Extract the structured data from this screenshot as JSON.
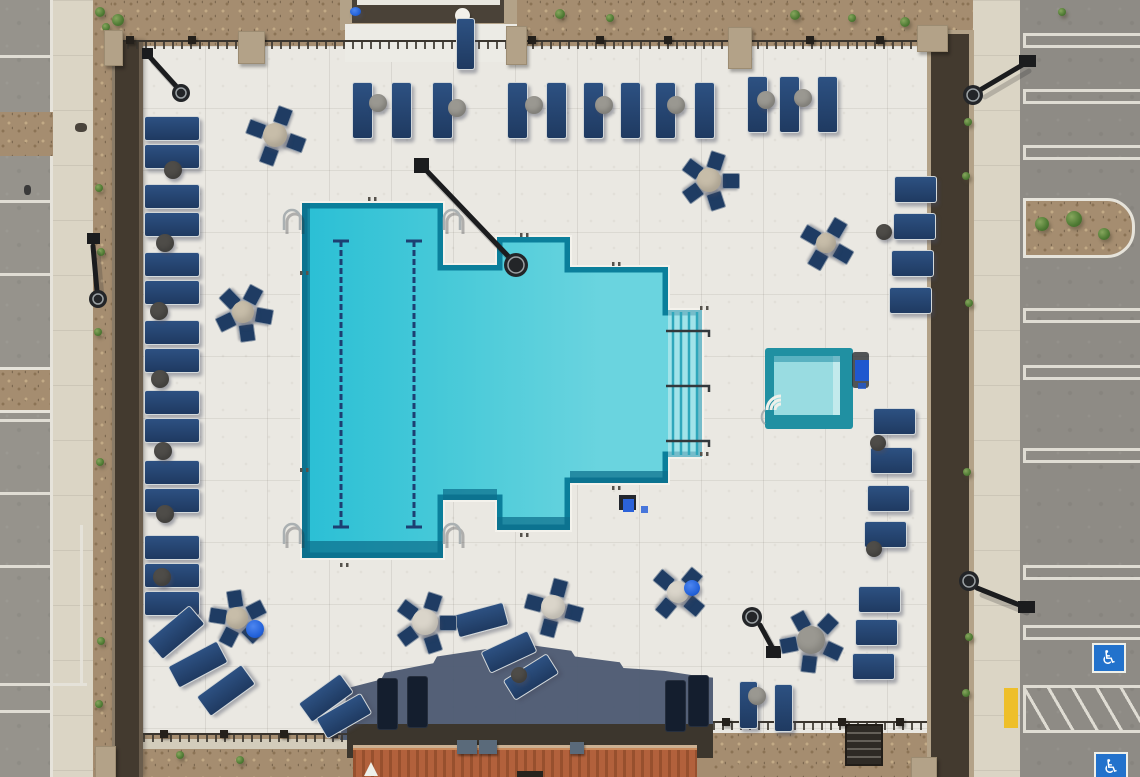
{
  "scene": {
    "kind": "aerial-photo",
    "subject": "apartment community swimming pool deck with spa, loungers and parking lots"
  },
  "icons": {
    "accessible_parking": "♿"
  },
  "colors": {
    "water_main": "#2abfd5",
    "water_mid": "#4ccbd9",
    "water_light": "#6ad4df",
    "water_edge": "#0b7f9b",
    "water_deep": "#0c6f8c",
    "spa_rim": "#2090a2",
    "spa_water": "#99dce1",
    "spa_bench": "#c2eaec",
    "deck": "#eae8e2",
    "asphalt": "#96938c",
    "asphalt2": "#8e8b85",
    "stall": "#e6e3da",
    "sidewalk": "#dbd5c5",
    "gravel": "#a58d70",
    "gravel_dot1": "#8b7355",
    "gravel_dot2": "#c2aa86",
    "wall_dark": "#433a2f",
    "wall_tan": "#b3a288",
    "fence": "#3a352e",
    "shadow": "#4d5b72",
    "roof": "#b2613c",
    "roof_dark": "#97502e",
    "patio": "#3c362d",
    "lounger": "#24456f",
    "lounger_shadow": "#16202f",
    "chair": "#1f3c63",
    "disc_beige": "#c7bda9",
    "disc_cream": "#dad5ca",
    "disc_gray": "#9a9891",
    "table_dark": "#4e4c48",
    "umbrella_blue": "#2160d8",
    "handicap_blue": "#2272cc",
    "curb_yellow": "#eebf2a",
    "lamp": "#1b1c1e",
    "metal": "#aab0b2",
    "white": "#f4f2ec"
  },
  "pool": {
    "outline": [
      [
        302,
        203
      ],
      [
        443,
        203
      ],
      [
        443,
        265
      ],
      [
        497,
        265
      ],
      [
        497,
        237
      ],
      [
        570,
        237
      ],
      [
        570,
        267
      ],
      [
        668,
        267
      ],
      [
        668,
        310
      ],
      [
        702,
        310
      ],
      [
        702,
        457
      ],
      [
        668,
        457
      ],
      [
        668,
        483
      ],
      [
        570,
        483
      ],
      [
        570,
        530
      ],
      [
        497,
        530
      ],
      [
        497,
        500
      ],
      [
        443,
        500
      ],
      [
        443,
        558
      ],
      [
        302,
        558
      ]
    ],
    "lane_lines": {
      "x": [
        341,
        414
      ],
      "y1": 241,
      "y2": 527
    },
    "bottom_bands": [
      [
        302,
        541,
        141,
        17
      ],
      [
        443,
        489,
        54,
        11
      ],
      [
        497,
        517,
        73,
        13
      ],
      [
        570,
        471,
        98,
        12
      ],
      [
        302,
        203,
        8,
        355
      ]
    ],
    "stairs": {
      "x1": 668,
      "x2": 702,
      "steps_x": [
        673,
        681,
        689,
        697
      ],
      "y1": 312,
      "y2": 455,
      "rails_y": [
        331,
        386,
        441
      ]
    },
    "grab_rails": [
      [
        288,
        214
      ],
      [
        448,
        214
      ],
      [
        288,
        528
      ],
      [
        448,
        528
      ]
    ],
    "depth_marks": [
      [
        368,
        197
      ],
      [
        520,
        233
      ],
      [
        612,
        262
      ],
      [
        340,
        563
      ],
      [
        520,
        533
      ],
      [
        612,
        486
      ],
      [
        300,
        271
      ],
      [
        300,
        468
      ],
      [
        700,
        306
      ],
      [
        700,
        452
      ]
    ],
    "lift": {
      "x": 619,
      "y": 495
    }
  },
  "spa": {
    "x": 765,
    "y": 348,
    "w": 88,
    "h": 81,
    "water": [
      774,
      356,
      66,
      59
    ],
    "bench": [
      833,
      356,
      7,
      59
    ],
    "steps_center": [
      781,
      410
    ],
    "cart": {
      "x": 852,
      "y": 352
    }
  },
  "furniture": {
    "loungers": [
      {
        "x": 144,
        "y": 116,
        "w": 54,
        "h": 23,
        "r": 0
      },
      {
        "x": 144,
        "y": 144,
        "w": 54,
        "h": 23,
        "r": 0
      },
      {
        "x": 144,
        "y": 184,
        "w": 54,
        "h": 23,
        "r": 0
      },
      {
        "x": 144,
        "y": 212,
        "w": 54,
        "h": 23,
        "r": 0
      },
      {
        "x": 144,
        "y": 252,
        "w": 54,
        "h": 23,
        "r": 0
      },
      {
        "x": 144,
        "y": 280,
        "w": 54,
        "h": 23,
        "r": 0
      },
      {
        "x": 144,
        "y": 320,
        "w": 54,
        "h": 23,
        "r": 0
      },
      {
        "x": 144,
        "y": 348,
        "w": 54,
        "h": 23,
        "r": 0
      },
      {
        "x": 144,
        "y": 390,
        "w": 54,
        "h": 23,
        "r": 0
      },
      {
        "x": 144,
        "y": 418,
        "w": 54,
        "h": 23,
        "r": 0
      },
      {
        "x": 144,
        "y": 460,
        "w": 54,
        "h": 23,
        "r": 0
      },
      {
        "x": 144,
        "y": 488,
        "w": 54,
        "h": 23,
        "r": 0
      },
      {
        "x": 144,
        "y": 535,
        "w": 54,
        "h": 23,
        "r": 0
      },
      {
        "x": 144,
        "y": 563,
        "w": 54,
        "h": 23,
        "r": 0
      },
      {
        "x": 144,
        "y": 591,
        "w": 54,
        "h": 23,
        "r": 0
      },
      {
        "x": 148,
        "y": 620,
        "w": 54,
        "h": 23,
        "r": -40
      },
      {
        "x": 170,
        "y": 652,
        "w": 54,
        "h": 23,
        "r": -28
      },
      {
        "x": 198,
        "y": 678,
        "w": 54,
        "h": 23,
        "r": -36
      },
      {
        "x": 352,
        "y": 82,
        "w": 19,
        "h": 55,
        "r": 0
      },
      {
        "x": 391,
        "y": 82,
        "w": 19,
        "h": 55,
        "r": 0
      },
      {
        "x": 432,
        "y": 82,
        "w": 19,
        "h": 55,
        "r": 0
      },
      {
        "x": 507,
        "y": 82,
        "w": 19,
        "h": 55,
        "r": 0
      },
      {
        "x": 546,
        "y": 82,
        "w": 19,
        "h": 55,
        "r": 0
      },
      {
        "x": 583,
        "y": 82,
        "w": 19,
        "h": 55,
        "r": 0
      },
      {
        "x": 620,
        "y": 82,
        "w": 19,
        "h": 55,
        "r": 0
      },
      {
        "x": 655,
        "y": 82,
        "w": 19,
        "h": 55,
        "r": 0
      },
      {
        "x": 694,
        "y": 82,
        "w": 19,
        "h": 55,
        "r": 0
      },
      {
        "x": 747,
        "y": 76,
        "w": 19,
        "h": 55,
        "r": 0
      },
      {
        "x": 779,
        "y": 76,
        "w": 19,
        "h": 55,
        "r": 0
      },
      {
        "x": 817,
        "y": 76,
        "w": 19,
        "h": 55,
        "r": 0
      },
      {
        "x": 456,
        "y": 18,
        "w": 17,
        "h": 50,
        "r": 0
      },
      {
        "x": 894,
        "y": 176,
        "w": 41,
        "h": 25,
        "r": 0
      },
      {
        "x": 893,
        "y": 213,
        "w": 41,
        "h": 25,
        "r": 0
      },
      {
        "x": 891,
        "y": 250,
        "w": 41,
        "h": 25,
        "r": 0
      },
      {
        "x": 889,
        "y": 287,
        "w": 41,
        "h": 25,
        "r": 0
      },
      {
        "x": 873,
        "y": 408,
        "w": 41,
        "h": 25,
        "r": 0
      },
      {
        "x": 870,
        "y": 447,
        "w": 41,
        "h": 25,
        "r": 0
      },
      {
        "x": 867,
        "y": 485,
        "w": 41,
        "h": 25,
        "r": 0
      },
      {
        "x": 864,
        "y": 521,
        "w": 41,
        "h": 25,
        "r": 0
      },
      {
        "x": 858,
        "y": 586,
        "w": 41,
        "h": 25,
        "r": 0
      },
      {
        "x": 855,
        "y": 619,
        "w": 41,
        "h": 25,
        "r": 0
      },
      {
        "x": 852,
        "y": 653,
        "w": 41,
        "h": 25,
        "r": 0
      },
      {
        "x": 455,
        "y": 608,
        "w": 50,
        "h": 22,
        "r": -15
      },
      {
        "x": 483,
        "y": 640,
        "w": 50,
        "h": 22,
        "r": -25
      },
      {
        "x": 505,
        "y": 665,
        "w": 50,
        "h": 22,
        "r": -32
      },
      {
        "x": 300,
        "y": 686,
        "w": 50,
        "h": 22,
        "r": -36
      },
      {
        "x": 318,
        "y": 704,
        "w": 50,
        "h": 22,
        "r": -30
      },
      {
        "x": 739,
        "y": 681,
        "w": 17,
        "h": 46,
        "r": 0
      },
      {
        "x": 774,
        "y": 684,
        "w": 17,
        "h": 46,
        "r": 0
      }
    ],
    "shadow_loungers": [
      {
        "x": 377,
        "y": 678
      },
      {
        "x": 407,
        "y": 676
      },
      {
        "x": 665,
        "y": 680
      },
      {
        "x": 688,
        "y": 675
      }
    ],
    "side_tables": [
      {
        "x": 173,
        "y": 170,
        "r": 9,
        "c": "table_dark"
      },
      {
        "x": 165,
        "y": 243,
        "r": 9,
        "c": "table_dark"
      },
      {
        "x": 159,
        "y": 311,
        "r": 9,
        "c": "table_dark"
      },
      {
        "x": 160,
        "y": 379,
        "r": 9,
        "c": "table_dark"
      },
      {
        "x": 163,
        "y": 451,
        "r": 9,
        "c": "table_dark"
      },
      {
        "x": 165,
        "y": 514,
        "r": 9,
        "c": "table_dark"
      },
      {
        "x": 162,
        "y": 577,
        "r": 9,
        "c": "table_dark"
      },
      {
        "x": 378,
        "y": 103,
        "r": 9,
        "c": "disc_gray"
      },
      {
        "x": 457,
        "y": 108,
        "r": 9,
        "c": "disc_gray"
      },
      {
        "x": 534,
        "y": 105,
        "r": 9,
        "c": "disc_gray"
      },
      {
        "x": 604,
        "y": 105,
        "r": 9,
        "c": "disc_gray"
      },
      {
        "x": 676,
        "y": 105,
        "r": 9,
        "c": "disc_gray"
      },
      {
        "x": 766,
        "y": 100,
        "r": 9,
        "c": "disc_gray"
      },
      {
        "x": 803,
        "y": 98,
        "r": 9,
        "c": "disc_gray"
      },
      {
        "x": 884,
        "y": 232,
        "r": 8,
        "c": "table_dark"
      },
      {
        "x": 878,
        "y": 443,
        "r": 8,
        "c": "table_dark"
      },
      {
        "x": 874,
        "y": 549,
        "r": 8,
        "c": "table_dark"
      },
      {
        "x": 519,
        "y": 675,
        "r": 8,
        "c": "table_dark"
      },
      {
        "x": 757,
        "y": 696,
        "r": 9,
        "c": "disc_gray"
      }
    ],
    "table_sets": [
      {
        "cx": 275,
        "cy": 135,
        "r": 12,
        "c": "disc_beige",
        "n": 4,
        "a0": 20
      },
      {
        "cx": 709,
        "cy": 180,
        "r": 12,
        "c": "disc_beige",
        "n": 5,
        "a0": 0
      },
      {
        "cx": 826,
        "cy": 243,
        "r": 10,
        "c": "disc_beige",
        "n": 4,
        "a0": 30
      },
      {
        "cx": 243,
        "cy": 312,
        "r": 11,
        "c": "disc_beige",
        "n": 5,
        "a0": 10
      },
      {
        "cx": 237,
        "cy": 618,
        "r": 11,
        "c": "disc_beige",
        "n": 5,
        "a0": 45,
        "blue": [
          255,
          629,
          9
        ]
      },
      {
        "cx": 553,
        "cy": 607,
        "r": 12,
        "c": "disc_cream",
        "n": 4,
        "a0": 15
      },
      {
        "cx": 425,
        "cy": 622,
        "r": 13,
        "c": "disc_cream",
        "n": 5,
        "a0": 0,
        "spokes": true
      },
      {
        "cx": 811,
        "cy": 640,
        "r": 14,
        "c": "disc_gray",
        "n": 5,
        "a0": 25,
        "spokes": true
      },
      {
        "cx": 678,
        "cy": 592,
        "r": 11,
        "c": "disc_cream",
        "n": 4,
        "a0": 40,
        "blue": [
          692,
          588,
          8
        ]
      }
    ]
  },
  "parking": {
    "left_lines_y": [
      55,
      128,
      200,
      273,
      419,
      492,
      565,
      710
    ],
    "left_vertical": [
      80,
      525,
      158
    ],
    "left_horizontal": [
      0,
      683,
      87
    ],
    "right_lines_y": [
      33,
      89,
      145,
      308,
      365,
      448,
      565,
      625
    ],
    "handicap": [
      [
        1092,
        643
      ],
      [
        1094,
        752
      ]
    ],
    "hatch": [
      1023,
      685,
      117,
      42
    ],
    "yellow_curb": [
      1004,
      688,
      14,
      40
    ]
  },
  "islands": {
    "right": {
      "x": 1023,
      "y": 198,
      "w": 106,
      "h": 54,
      "trees": [
        [
          1042,
          224,
          7
        ],
        [
          1074,
          219,
          8
        ],
        [
          1104,
          234,
          6
        ]
      ]
    },
    "left": {
      "x": 0,
      "y": 367,
      "w": 50,
      "h": 40,
      "shrub": [
        27,
        386,
        6
      ]
    }
  },
  "plants": [
    [
      100,
      12,
      5
    ],
    [
      106,
      27,
      4
    ],
    [
      118,
      20,
      6
    ],
    [
      99,
      188,
      4
    ],
    [
      101,
      252,
      4
    ],
    [
      98,
      332,
      4
    ],
    [
      100,
      462,
      4
    ],
    [
      101,
      641,
      4
    ],
    [
      99,
      704,
      4
    ],
    [
      968,
      122,
      4
    ],
    [
      966,
      176,
      4
    ],
    [
      969,
      303,
      4
    ],
    [
      967,
      472,
      4
    ],
    [
      969,
      637,
      4
    ],
    [
      966,
      693,
      4
    ],
    [
      560,
      14,
      5
    ],
    [
      610,
      18,
      4
    ],
    [
      795,
      15,
      5
    ],
    [
      852,
      18,
      4
    ],
    [
      905,
      22,
      5
    ],
    [
      1062,
      12,
      4
    ],
    [
      180,
      755,
      4
    ],
    [
      240,
      760,
      4
    ]
  ],
  "rocks": [
    [
      75,
      123
    ]
  ],
  "lamps": [
    {
      "base": [
        142,
        48,
        11,
        11
      ],
      "arm": [
        148,
        55,
        176,
        86
      ],
      "head": [
        181,
        93,
        9
      ]
    },
    {
      "base": [
        414,
        158,
        15,
        15
      ],
      "arm": [
        424,
        168,
        508,
        256
      ],
      "head": [
        516,
        265,
        12
      ]
    },
    {
      "base": [
        766,
        646,
        15,
        12
      ],
      "arm": [
        773,
        649,
        760,
        625
      ],
      "head": [
        752,
        617,
        10
      ]
    },
    {
      "base": [
        1019,
        55,
        17,
        12
      ],
      "arm": [
        1024,
        64,
        980,
        90
      ],
      "head": [
        973,
        95,
        10
      ]
    },
    {
      "base": [
        1018,
        601,
        17,
        12
      ],
      "arm": [
        1022,
        606,
        977,
        588
      ],
      "head": [
        969,
        581,
        10
      ]
    },
    {
      "base": [
        87,
        233,
        13,
        11
      ],
      "arm": [
        93,
        246,
        97,
        291
      ],
      "head": [
        98,
        299,
        9
      ]
    }
  ],
  "fence": {
    "posts_top_x": [
      126,
      188,
      256,
      528,
      596,
      664,
      736,
      806,
      876
    ],
    "posts_bl_x": [
      160,
      220,
      280,
      330
    ],
    "posts_br_x": [
      722,
      780,
      838,
      896
    ],
    "pilasters": [
      [
        104,
        30,
        17,
        34
      ],
      [
        238,
        31,
        25,
        31
      ],
      [
        506,
        26,
        19,
        37
      ],
      [
        728,
        27,
        22,
        40
      ],
      [
        917,
        25,
        29,
        25
      ],
      [
        95,
        746,
        19,
        31
      ],
      [
        911,
        757,
        24,
        20
      ]
    ]
  },
  "misc": {
    "person": [
      24,
      185
    ],
    "structure_blue": [
      350,
      7
    ],
    "platform_table": [
      455,
      8
    ],
    "flag": [
      364,
      762
    ],
    "patio_boxes": [
      [
        457,
        740,
        20,
        14
      ],
      [
        479,
        740,
        18,
        14
      ],
      [
        570,
        742,
        14,
        12
      ]
    ],
    "doorway": [
      517,
      771,
      26,
      6
    ]
  }
}
